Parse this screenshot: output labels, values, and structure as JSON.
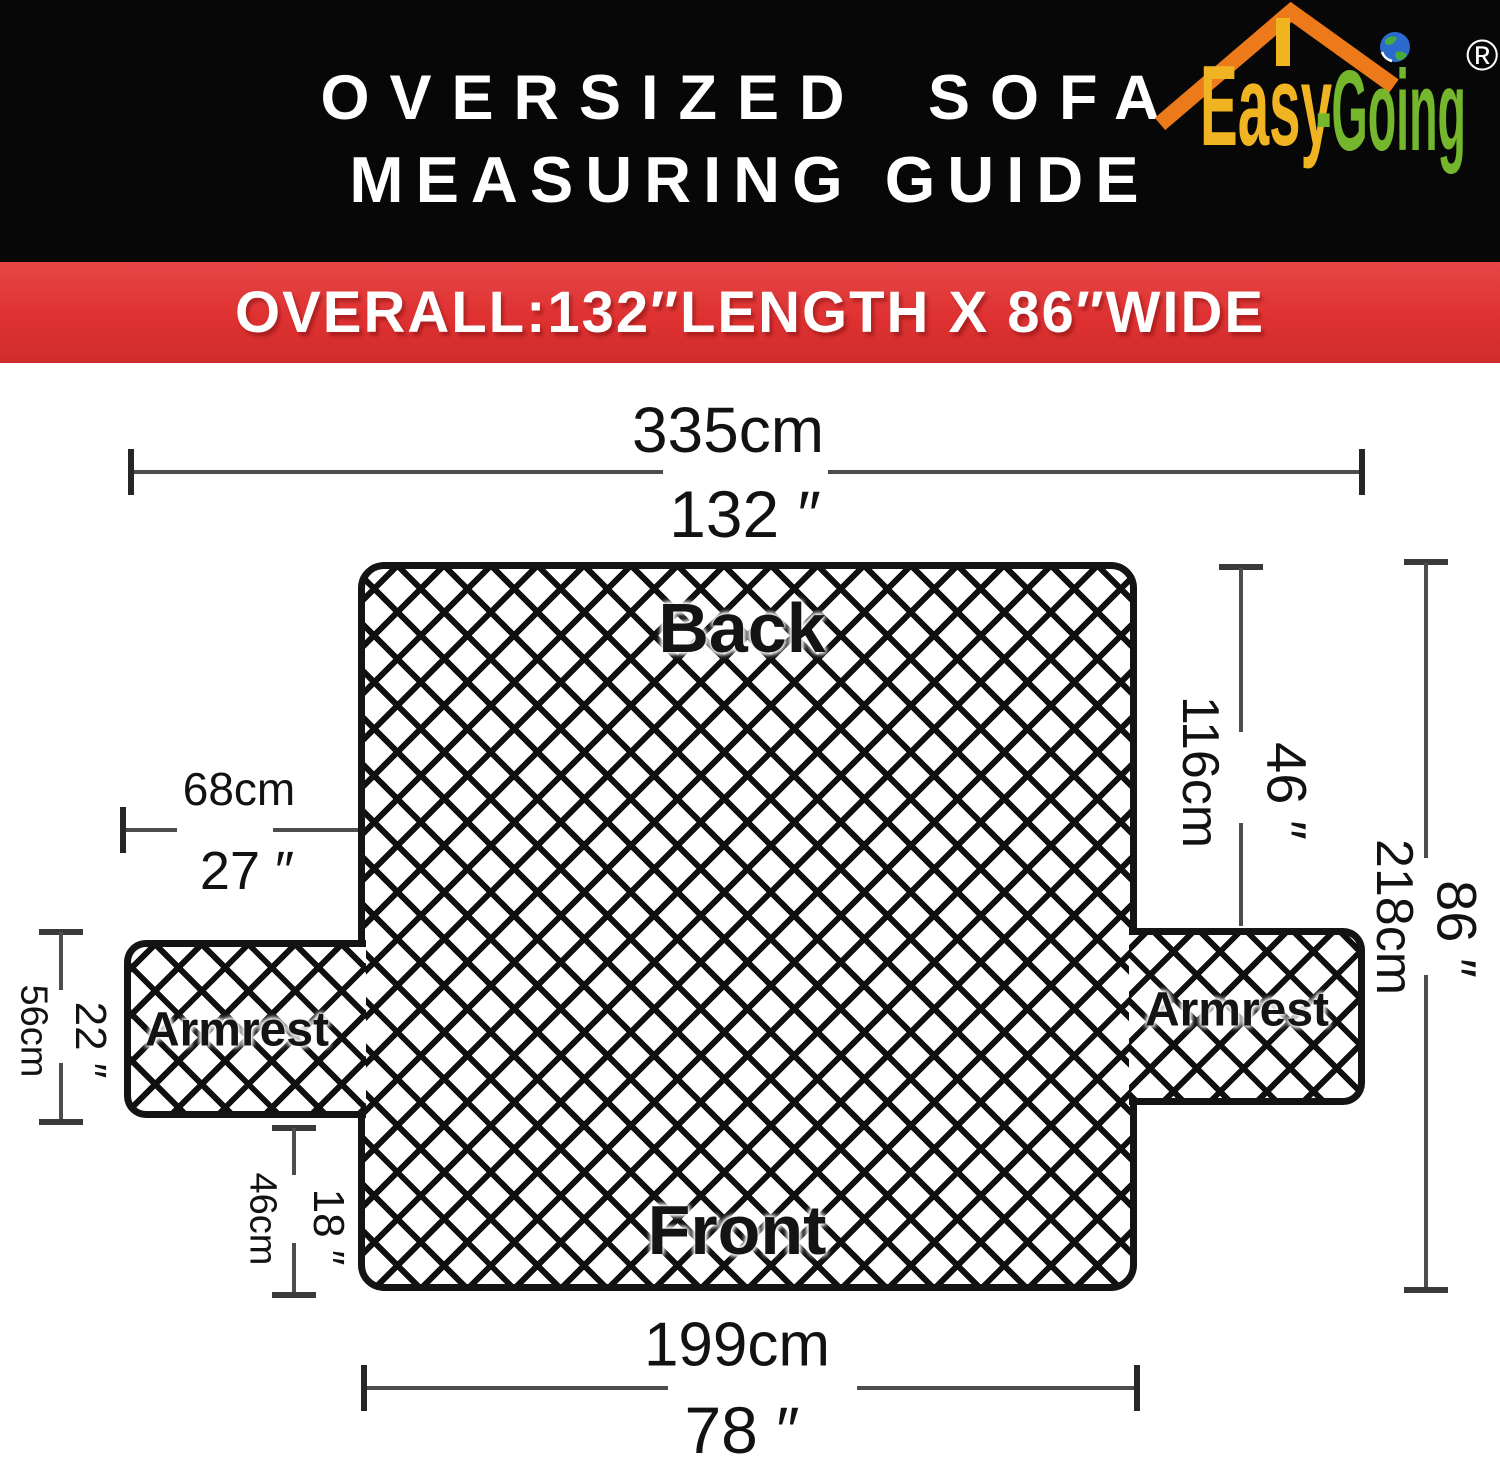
{
  "header": {
    "title_line1": "OVERSIZED SOFA",
    "title_line2": "MEASURING GUIDE",
    "banner": "OVERALL:132″LENGTH X 86″WIDE"
  },
  "logo": {
    "brand_first": "Easy",
    "brand_second": "-Going",
    "registered_mark": "®",
    "icons": [
      "roof-icon",
      "chimney-icon",
      "globe-icon"
    ]
  },
  "diagram": {
    "labels": {
      "back": "Back",
      "front": "Front",
      "armrest_left": "Armrest",
      "armrest_right": "Armrest"
    },
    "dimensions": {
      "overall_length": {
        "cm": "335cm",
        "inch": "132 ″"
      },
      "armrest_depth": {
        "cm": "68cm",
        "inch": "27 ″"
      },
      "armrest_height": {
        "cm": "56cm",
        "inch": "22 ″"
      },
      "front_skirt_height": {
        "cm": "46cm",
        "inch": "18 ″"
      },
      "back_height": {
        "cm": "116cm",
        "inch": "46 ″"
      },
      "overall_width": {
        "cm": "218cm",
        "inch": "86 ″"
      },
      "seat_front_length": {
        "cm": "199cm",
        "inch": "78 ″"
      }
    }
  },
  "colors": {
    "header_bg": "#070707",
    "banner_red": "#df3131",
    "logo_orange": "#ec7a1a",
    "logo_yellow": "#f0b422",
    "logo_green": "#74b72c",
    "globe_blue": "#2a6bcd",
    "line_gray": "#4d4d4d",
    "ink": "#141414"
  }
}
